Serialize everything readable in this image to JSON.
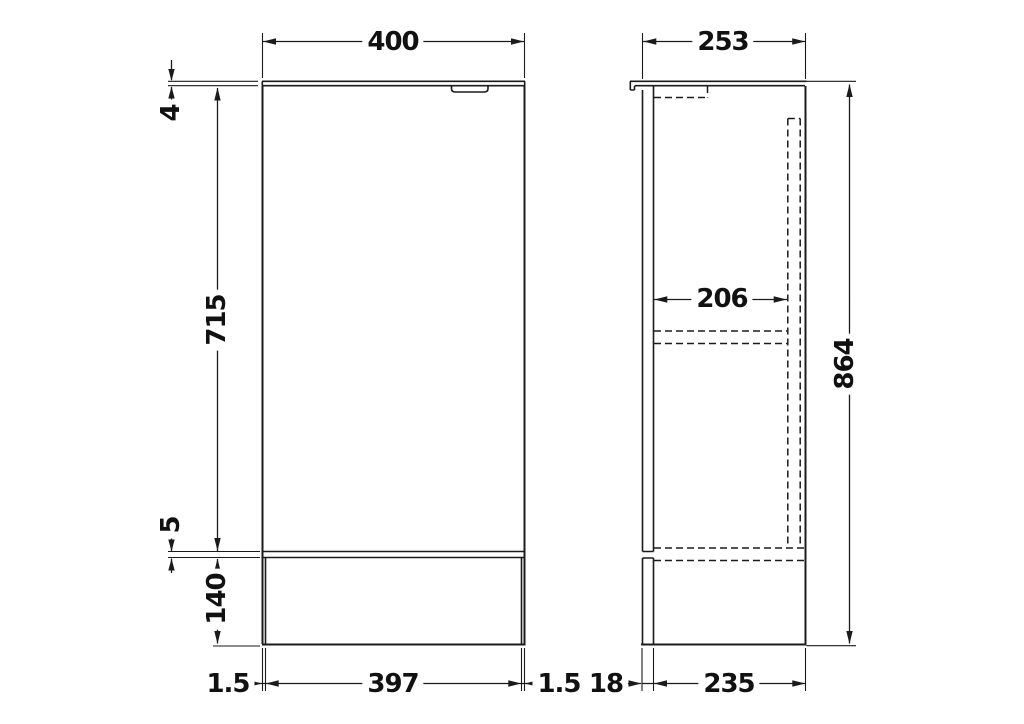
{
  "views": {
    "front": {
      "dims": {
        "overall_width": "400",
        "worktop_thickness": "4",
        "door_height": "715",
        "gap_door_plinth": "5",
        "plinth_height": "140",
        "plinth_inset_left": "1.5",
        "plinth_width": "397",
        "plinth_inset_right": "1.5"
      }
    },
    "side": {
      "dims": {
        "overall_depth": "253",
        "internal_depth": "206",
        "overall_height": "864",
        "front_offset": "18",
        "carcass_depth": "235"
      }
    }
  },
  "style": {
    "line_color": "#1b1b1b",
    "background": "#ffffff"
  }
}
